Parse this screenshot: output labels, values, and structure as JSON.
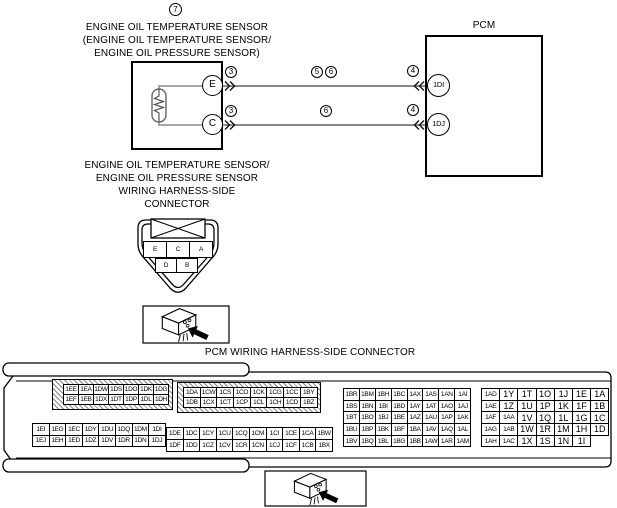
{
  "colors": {
    "wire_gray": "#8a8a8a",
    "line_black": "#000000"
  },
  "diagram": {
    "callout_number": "7",
    "sensor_title": "ENGINE OIL TEMPERATURE SENSOR\n(ENGINE OIL TEMPERATURE SENSOR/\nENGINE OIL PRESSURE SENSOR)",
    "pcm_label": "PCM",
    "sensor_terminals": {
      "top": "E",
      "bottom": "C"
    },
    "pcm_terminals": {
      "top": "1DI",
      "bottom": "1DJ"
    },
    "markers": {
      "m3a": "3",
      "m3b": "3",
      "m5": "5",
      "m6a": "6",
      "m6b": "6",
      "m4a": "4",
      "m4b": "4"
    }
  },
  "sensor_connector": {
    "title": "ENGINE OIL TEMPERATURE SENSOR/\nENGINE OIL PRESSURE SENSOR\nWIRING HARNESS-SIDE\nCONNECTOR",
    "pin_rows_top": [
      [
        "E",
        "C",
        "A"
      ]
    ],
    "pin_rows_bottom": [
      [
        "D",
        "B"
      ]
    ]
  },
  "pcm_connector": {
    "title": "PCM WIRING HARNESS-SIDE CONNECTOR",
    "groups": {
      "a": [
        [
          "1EE",
          "1EA",
          "1DW",
          "1DS",
          "1DO",
          "1DK",
          "1DG"
        ],
        [
          "1EF",
          "1EB",
          "1DX",
          "1DT",
          "1DP",
          "1DL",
          "1DH"
        ]
      ],
      "b": [
        [
          "1EI",
          "1EG",
          "1EC",
          "1DY",
          "1DU",
          "1DQ",
          "1DM",
          "1DI"
        ],
        [
          "1EJ",
          "1EH",
          "1ED",
          "1DZ",
          "1DV",
          "1DR",
          "1DN",
          "1DJ"
        ]
      ],
      "c": [
        [
          "1DA",
          "1CW",
          "1CS",
          "1CO",
          "1CK",
          "1CG",
          "1CC",
          "1BY"
        ],
        [
          "1DB",
          "1CX",
          "1CT",
          "1CP",
          "1CL",
          "1CH",
          "1CD",
          "1BZ"
        ]
      ],
      "d": [
        [
          "1DE",
          "1DC",
          "1CY",
          "1CU",
          "1CQ",
          "1CM",
          "1CI",
          "1CE",
          "1CA",
          "1BW"
        ],
        [
          "1DF",
          "1DD",
          "1CZ",
          "1CV",
          "1CR",
          "1CN",
          "1CJ",
          "1CF",
          "1CB",
          "1BX"
        ]
      ],
      "e": [
        [
          "1BR",
          "1BM",
          "1BH",
          "1BC",
          "1AX",
          "1AS",
          "1AN",
          "1AI"
        ],
        [
          "1BS",
          "1BN",
          "1BI",
          "1BD",
          "1AY",
          "1AT",
          "1AO",
          "1AJ"
        ],
        [
          "1BT",
          "1BO",
          "1BJ",
          "1BE",
          "1AZ",
          "1AU",
          "1AP",
          "1AK"
        ],
        [
          "1BU",
          "1BP",
          "1BK",
          "1BF",
          "1BA",
          "1AV",
          "1AQ",
          "1AL"
        ],
        [
          "1BV",
          "1BQ",
          "1BL",
          "1BG",
          "1BB",
          "1AW",
          "1AR",
          "1AM"
        ]
      ],
      "f": [
        [
          "1AD",
          "1Y",
          "1T",
          "1O",
          "1J",
          "1E",
          "1A"
        ],
        [
          "1AE",
          "1Z",
          "1U",
          "1P",
          "1K",
          "1F",
          "1B"
        ],
        [
          "1AF",
          "1AA",
          "1V",
          "1Q",
          "1L",
          "1G",
          "1C"
        ],
        [
          "1AG",
          "1AB",
          "1W",
          "1R",
          "1M",
          "1H",
          "1D"
        ],
        [
          "1AH",
          "1AC",
          "1X",
          "1S",
          "1N",
          "1I"
        ]
      ]
    }
  }
}
